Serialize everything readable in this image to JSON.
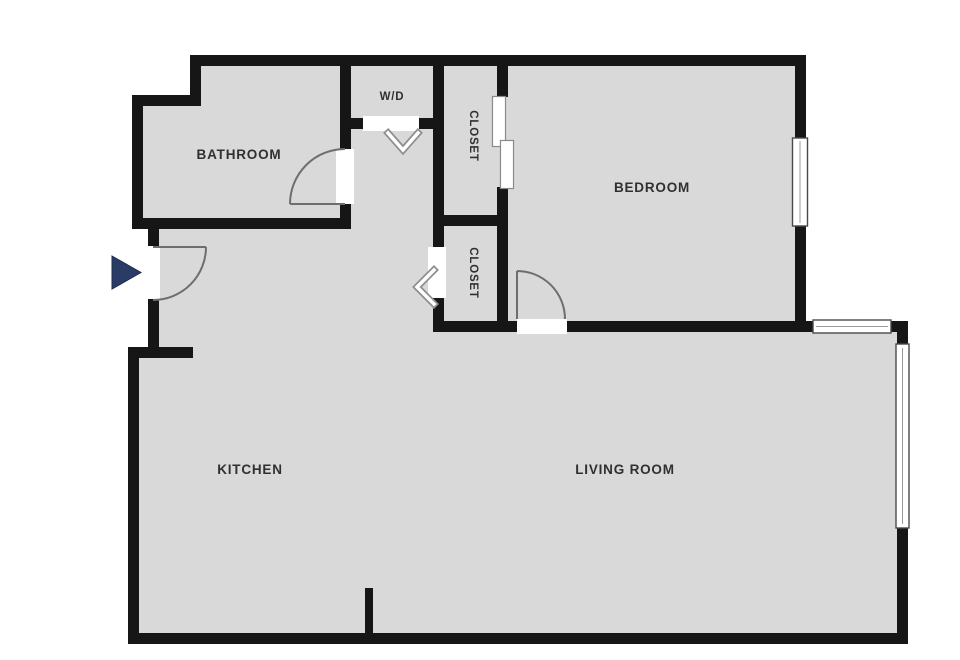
{
  "plan": {
    "title": "apartment-floor-plan",
    "colors": {
      "background": "#ffffff",
      "wall": "#161616",
      "floor": "#d9d9d9",
      "door_line": "#6e6e6e",
      "window_outline": "#4a4a4a",
      "entry_arrow": "#2a3c66",
      "label_text": "#303030"
    },
    "rooms": [
      {
        "id": "bathroom",
        "label": "BATHROOM"
      },
      {
        "id": "wd",
        "label": "W/D"
      },
      {
        "id": "closet-upper",
        "label": "CLOSET"
      },
      {
        "id": "closet-lower",
        "label": "CLOSET"
      },
      {
        "id": "bedroom",
        "label": "BEDROOM"
      },
      {
        "id": "kitchen",
        "label": "KITCHEN"
      },
      {
        "id": "living-room",
        "label": "LIVING ROOM"
      }
    ],
    "features": {
      "entry_marker": "entry-arrow",
      "doors": [
        "entry-door",
        "bathroom-door",
        "bedroom-door"
      ],
      "bifold_doors": [
        "wd-bifold",
        "closet-lower-bifold"
      ],
      "sliding_doors": [
        "closet-upper-sliding"
      ],
      "windows": [
        "bedroom-window",
        "living-room-top-window",
        "living-room-right-window"
      ]
    }
  }
}
